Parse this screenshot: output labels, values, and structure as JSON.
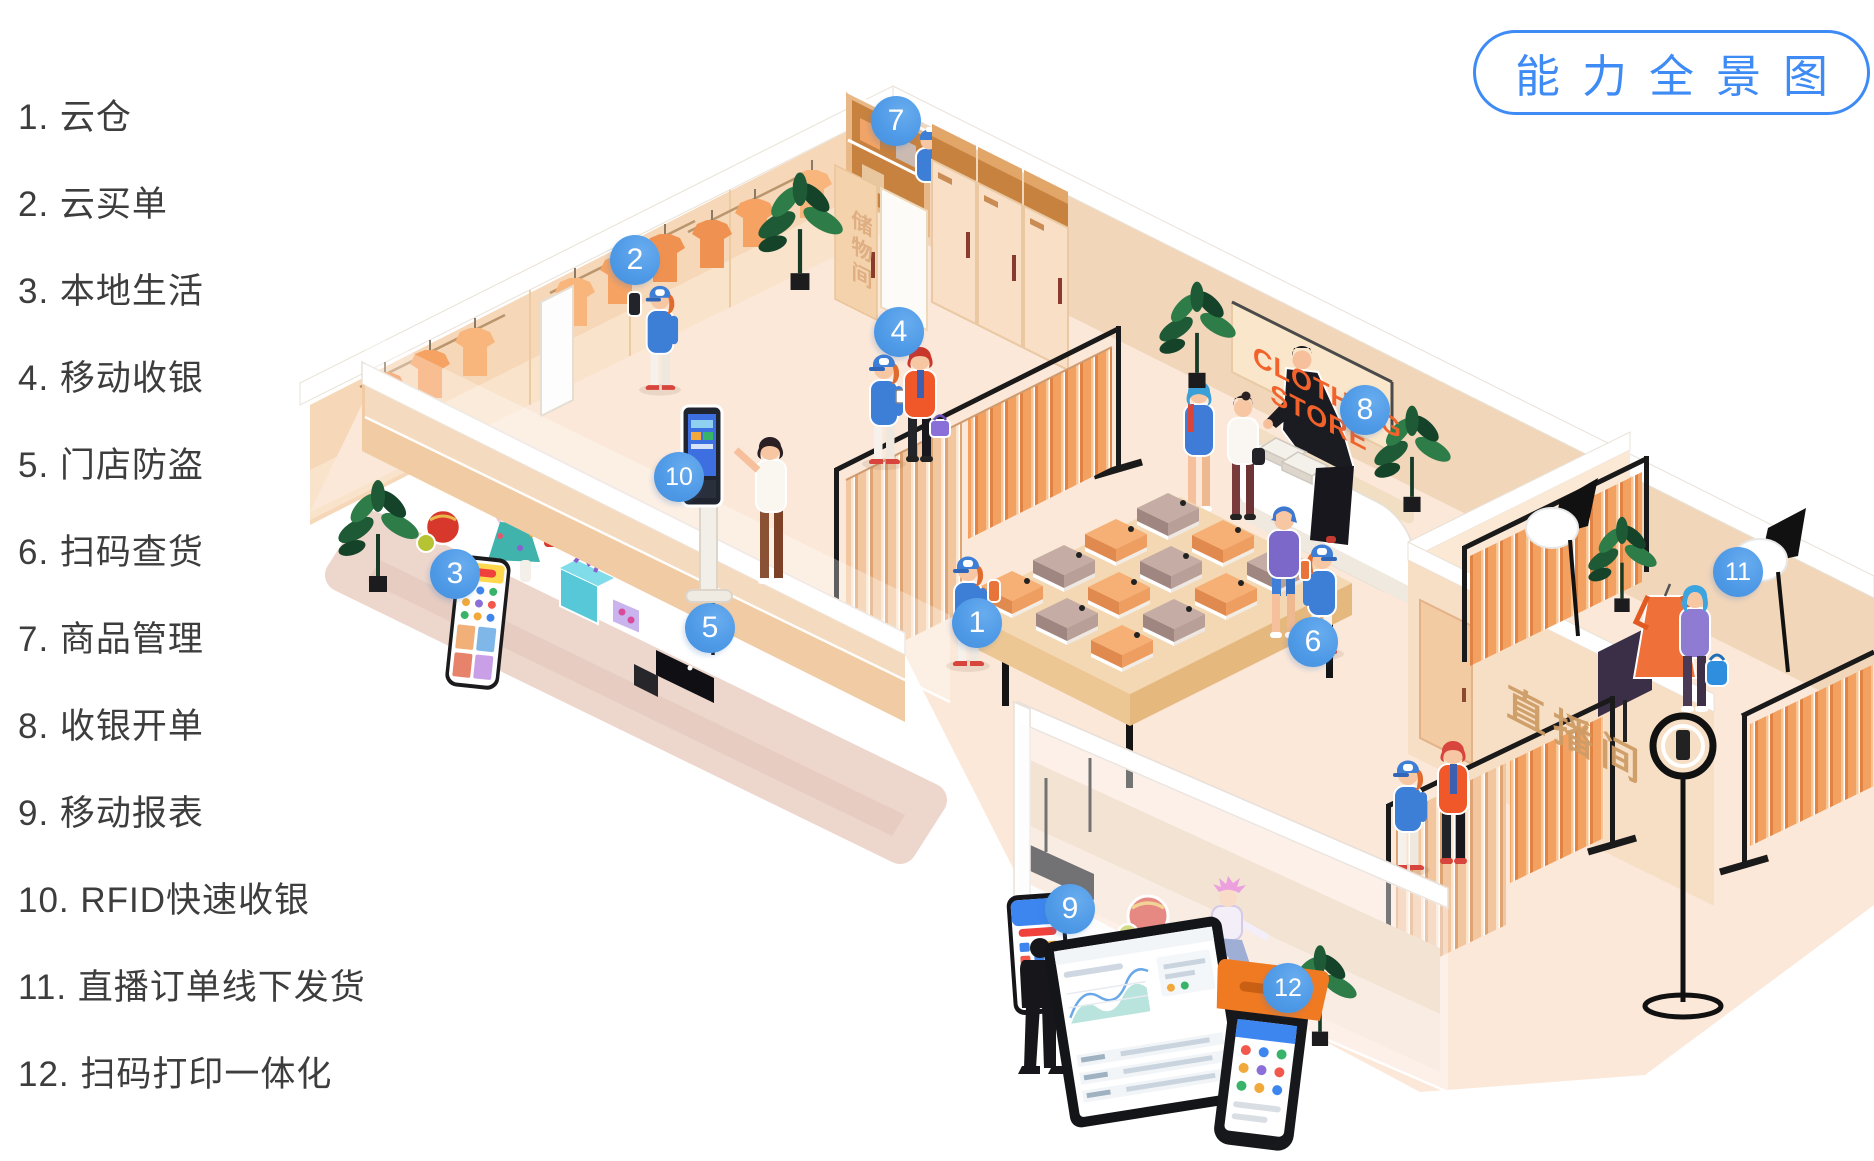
{
  "title_badge": {
    "label": "能力全景图"
  },
  "legend": {
    "items": [
      {
        "number": "1",
        "label": "1. 云仓"
      },
      {
        "number": "2",
        "label": "2. 云买单"
      },
      {
        "number": "3",
        "label": "3. 本地生活"
      },
      {
        "number": "4",
        "label": "4. 移动收银"
      },
      {
        "number": "5",
        "label": "5. 门店防盗"
      },
      {
        "number": "6",
        "label": "6. 扫码查货"
      },
      {
        "number": "7",
        "label": "7. 商品管理"
      },
      {
        "number": "8",
        "label": "8. 收银开单"
      },
      {
        "number": "9",
        "label": "9. 移动报表"
      },
      {
        "number": "10",
        "label": "10. RFID快速收银"
      },
      {
        "number": "11",
        "label": "11. 直播订单线下发货"
      },
      {
        "number": "12",
        "label": "12. 扫码打印一体化"
      }
    ]
  },
  "markers": [
    {
      "number": "1",
      "name": "云仓"
    },
    {
      "number": "2",
      "name": "云买单"
    },
    {
      "number": "3",
      "name": "本地生活"
    },
    {
      "number": "4",
      "name": "移动收银"
    },
    {
      "number": "5",
      "name": "门店防盗"
    },
    {
      "number": "6",
      "name": "扫码查货"
    },
    {
      "number": "7",
      "name": "商品管理"
    },
    {
      "number": "8",
      "name": "收银开单"
    },
    {
      "number": "9",
      "name": "移动报表"
    },
    {
      "number": "10",
      "name": "RFID快速收银"
    },
    {
      "number": "11",
      "name": "直播订单线下发货"
    },
    {
      "number": "12",
      "name": "扫码打印一体化"
    }
  ],
  "signs": {
    "store_line1": "CLOTHING",
    "store_line2": "STORE",
    "live_room": "直播间",
    "storage_room": "储物间"
  },
  "colors": {
    "accent_blue": "#4f9ae7",
    "title_blue": "#3e8bf5",
    "sign_orange": "#f2622b",
    "floor": "#fbe8d9",
    "wall_left": "#f6d7b8",
    "wall_right": "#f2d6ba",
    "clothes_orange": "#f2a161"
  }
}
